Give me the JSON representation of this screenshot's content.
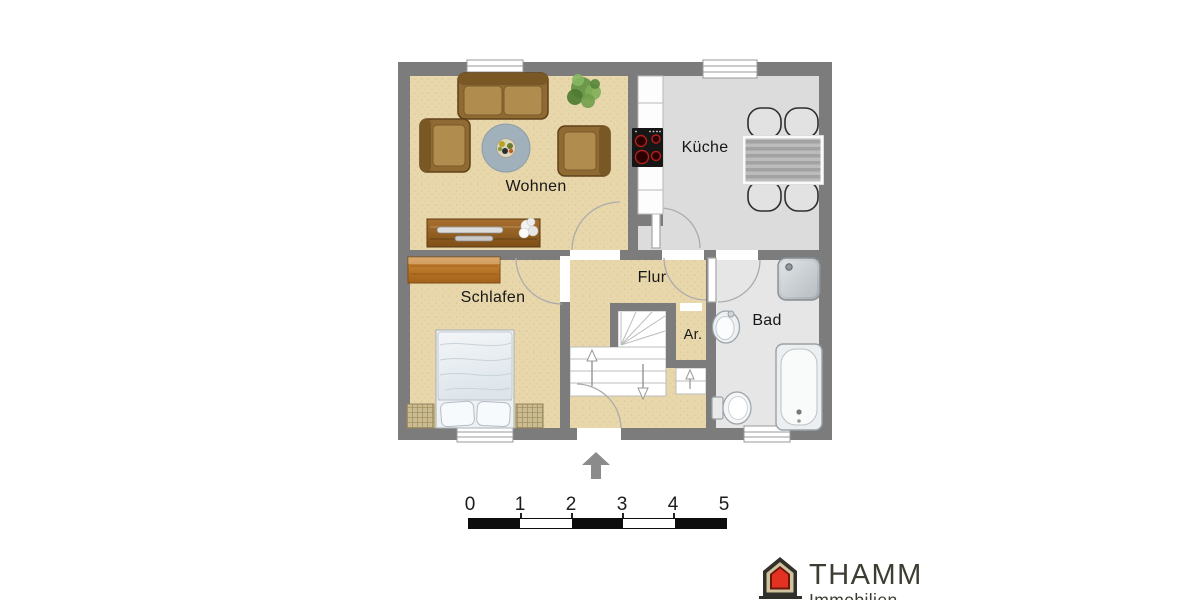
{
  "page": {
    "type": "floor-plan",
    "background": "#ffffff"
  },
  "floorplan": {
    "rooms": [
      {
        "label": "Wohnen"
      },
      {
        "label": "Küche"
      },
      {
        "label": "Schlafen"
      },
      {
        "label": "Flur"
      },
      {
        "label": "Ar."
      },
      {
        "label": "Bad"
      }
    ],
    "colors": {
      "wall": "#7c7c7c",
      "floor_living": "#e9d7ac",
      "floor_kitchen": "#dcdcdc",
      "floor_bath": "#e6e6e6",
      "stairs": "#ffffff"
    }
  },
  "scale_bar": {
    "labels": [
      "0",
      "1",
      "2",
      "3",
      "4",
      "5"
    ],
    "bar_color": "#0d0d0d"
  },
  "compass": {
    "direction": "up",
    "color": "#8b8b8b"
  },
  "logo": {
    "name": "THAMM",
    "subtitle": "Immobilien",
    "accent": "#e33122",
    "text_color": "#3e3d33"
  }
}
